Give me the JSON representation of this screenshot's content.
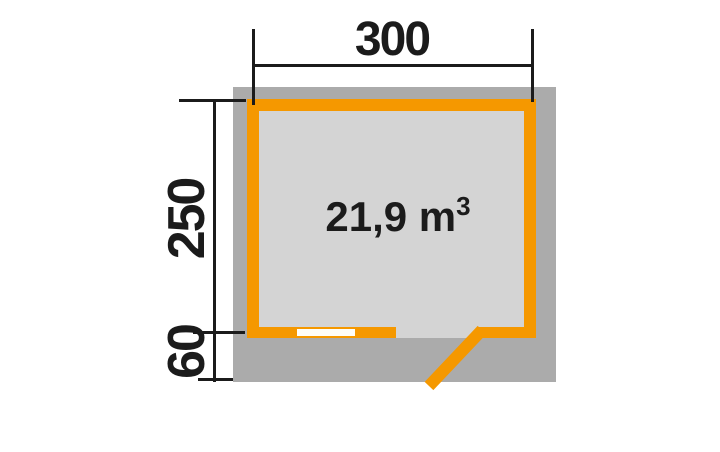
{
  "colors": {
    "accent-orange": "#F59800",
    "footprint-gray": "#ABABAB",
    "interior-gray": "#D4D4D4",
    "line-black": "#1B1B1B",
    "window-white": "#FFFEF8",
    "page-bg": "#FFFFFF"
  },
  "plan": {
    "area": {
      "text": "21,9 m",
      "exponent": "3"
    },
    "dims": {
      "width": "300",
      "depth": "250",
      "overhang": "60"
    },
    "features": {
      "door": "door-swing",
      "window": "window-opening"
    }
  }
}
